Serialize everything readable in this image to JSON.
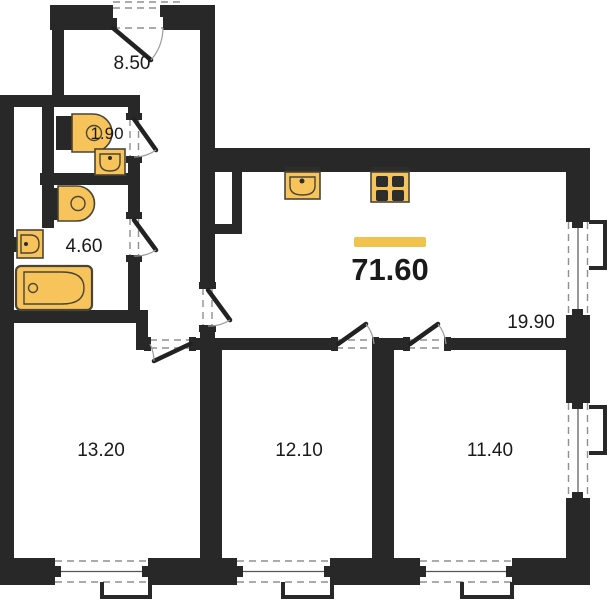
{
  "plan": {
    "type": "floor-plan",
    "total_area_label": "71.60",
    "rooms": [
      {
        "name": "hallway",
        "area_label": "8.50"
      },
      {
        "name": "wc",
        "area_label": "1.90"
      },
      {
        "name": "bathroom",
        "area_label": "4.60"
      },
      {
        "name": "living-kitchen",
        "area_label": "19.90"
      },
      {
        "name": "bedroom-left",
        "area_label": "13.20"
      },
      {
        "name": "bedroom-middle",
        "area_label": "12.10"
      },
      {
        "name": "bedroom-right",
        "area_label": "11.40"
      }
    ],
    "fixtures": [
      "toilet",
      "sink",
      "bathtub",
      "kitchen-sink",
      "stove"
    ],
    "colors": {
      "wall": "#282828",
      "fixture_fill": "#F7C45C",
      "fixture_stroke": "#4a4434",
      "accent_bar": "#F2C24E",
      "label_text": "#1a1a1a",
      "dash": "#8f8f8f",
      "arc": "#9a9a9a"
    }
  }
}
